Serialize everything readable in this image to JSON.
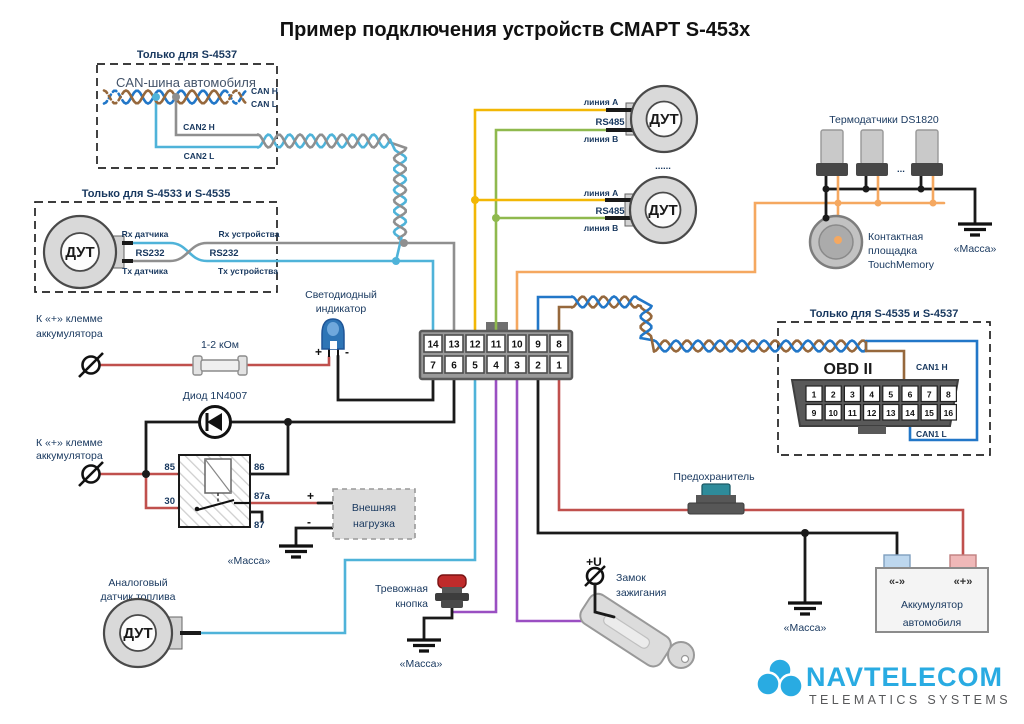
{
  "title": "Пример подключения устройств СМАРТ S-453x",
  "colors": {
    "wire_cyan": "#4FB3D9",
    "wire_gray": "#8F8F8F",
    "wire_yellow": "#F2B705",
    "wire_green": "#8FB94E",
    "wire_orange": "#F5A860",
    "wire_blue": "#2277C8",
    "wire_brown": "#96683C",
    "wire_purple": "#9A4FC2",
    "wire_red": "#C0504D",
    "wire_black": "#1A1A1A",
    "label": "#17375E",
    "muted_label": "#44546A",
    "led_blue": "#2E75B6",
    "logo_blue": "#29ABE2",
    "logo_gray": "#58595B",
    "button_red": "#C02B2B",
    "fuse_teal": "#2E8B9A",
    "battery_minus_fill": "#BDD7EE",
    "battery_plus_fill": "#EFB8B8"
  },
  "can_box": {
    "title": "Только для S-4537",
    "heading": "CAN-шина автомобиля",
    "can_h": "CAN H",
    "can_l": "CAN L",
    "can2_h": "CAN2 H",
    "can2_l": "CAN2 L"
  },
  "rs232_box": {
    "title": "Только для S-4533 и S-4535",
    "sensor_label": "ДУТ",
    "rx_sensor": "Rx датчика",
    "tx_sensor": "Tx датчика",
    "rs232_sensor": "RS232",
    "rs232_device": "RS232",
    "rx_device": "Rx устройства",
    "tx_device": "Tx устройства"
  },
  "rs485": {
    "sensor1_label": "ДУТ",
    "sensor2_label": "ДУТ",
    "line_a1": "линия A",
    "bus1": "RS485",
    "line_b1": "линия B",
    "line_a2": "линия A",
    "bus2": "RS485",
    "line_b2": "линия B",
    "dots": "......"
  },
  "thermo": {
    "title": "Термодатчики DS1820",
    "dots": "...",
    "pad_line1": "Контактная",
    "pad_line2": "площадка",
    "pad_line3": "TouchMemory",
    "ground": "«Масса»"
  },
  "obd": {
    "box_title": "Только для S-4535 и S-4537",
    "heading": "OBD II",
    "can1_h": "CAN1 H",
    "can1_l": "CAN1 L",
    "pins_top": [
      "1",
      "2",
      "3",
      "4",
      "5",
      "6",
      "7",
      "8"
    ],
    "pins_bottom": [
      "9",
      "10",
      "11",
      "12",
      "13",
      "14",
      "15",
      "16"
    ]
  },
  "main_connector": {
    "pins_top": [
      "14",
      "13",
      "12",
      "11",
      "10",
      "9",
      "8"
    ],
    "pins_bottom": [
      "7",
      "6",
      "5",
      "4",
      "3",
      "2",
      "1"
    ]
  },
  "led": {
    "label1": "Светодиодный",
    "label2": "индикатор",
    "plus": "+",
    "minus": "-"
  },
  "batt_plus_top": {
    "label1": "К «+» клемме",
    "label2": "аккумулятора"
  },
  "batt_plus_bottom": {
    "label1": "К «+» клемме",
    "label2": "аккумулятора"
  },
  "resistor": {
    "label": "1-2 кОм"
  },
  "diode": {
    "label": "Диод 1N4007"
  },
  "relay": {
    "pin85": "85",
    "pin86": "86",
    "pin30": "30",
    "pin87a": "87a",
    "pin87": "87"
  },
  "load": {
    "label1": "Внешняя",
    "label2": "нагрузка",
    "plus": "+",
    "minus": "-",
    "ground": "«Масса»"
  },
  "analog_sensor": {
    "label1": "Аналоговый",
    "label2": "датчик топлива",
    "sensor_label": "ДУТ"
  },
  "alarm": {
    "label1": "Тревожная",
    "label2": "кнопка",
    "ground": "«Масса»"
  },
  "ignition": {
    "voltage": "+U",
    "label1": "Замок",
    "label2": "зажигания"
  },
  "fuse": {
    "label": "Предохранитель"
  },
  "battery": {
    "minus": "«-»",
    "plus": "«+»",
    "label1": "Аккумулятор",
    "label2": "автомобиля",
    "ground": "«Масса»"
  },
  "logo": {
    "name": "NAVTELECOM",
    "tagline": "TELEMATICS SYSTEMS"
  }
}
